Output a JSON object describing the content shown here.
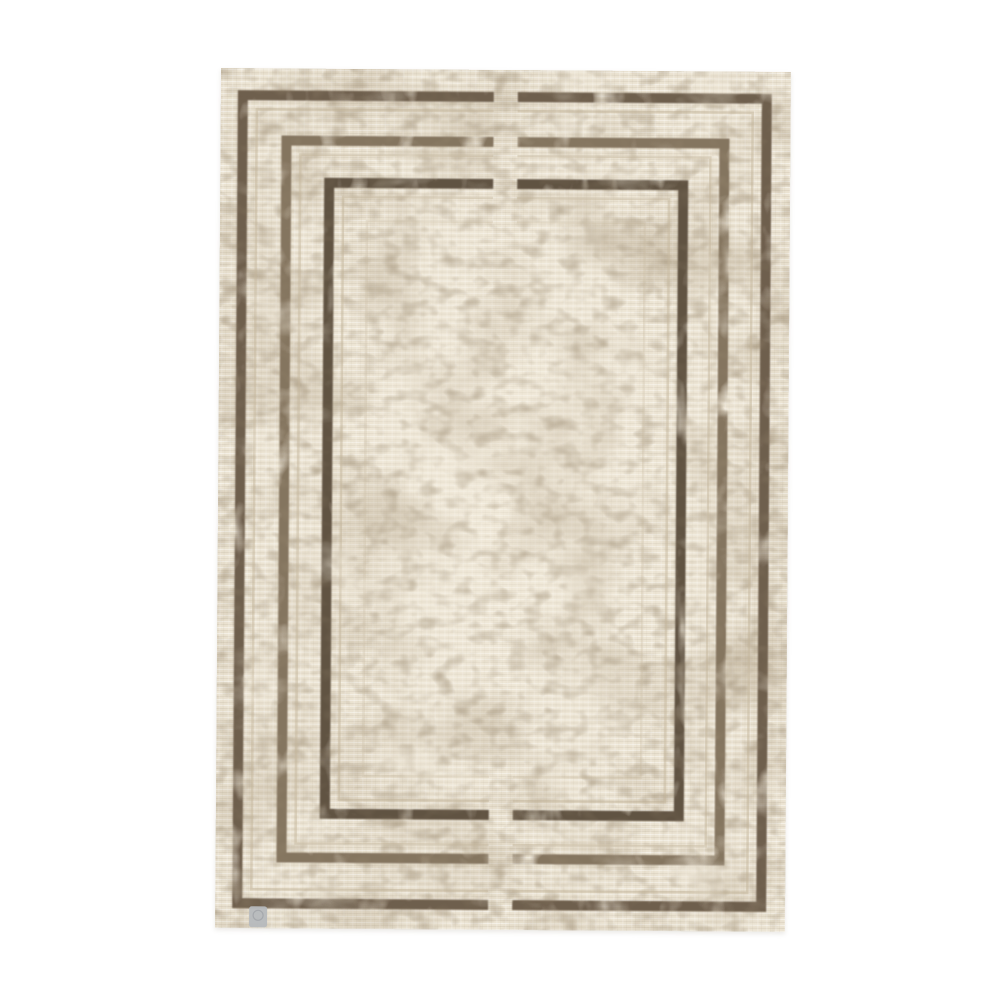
{
  "scene": {
    "description": "Product photograph of a rectangular vintage-style area rug lying flat on a plain white background. The rug has a distressed cream base with heavy taupe mottling and three nested dark-brown rectangular border frames. Each frame is interrupted by a short vertical gap at the top-center and bottom-center midline. A small grey fabric brand tag sits at the bottom-left edge of the rug.",
    "orientation": "portrait",
    "background": "plain white studio background",
    "objects": [
      "distressed area rug",
      "small grey fabric brand tag"
    ],
    "pattern": {
      "type": "nested rectangular border frames",
      "frame_count": 3,
      "center_gap": "frames break with a vertical gap at top and bottom midline",
      "finish": "eroded, worn, vintage distressed line edges",
      "texture": "horizontal weft striations with mottled taupe wear patches"
    },
    "colors": {
      "page_background": "#ffffff",
      "rug_base": "#ebe3d2",
      "rug_base_light": "#f3ecdd",
      "texture_taupe": "#ac9c82",
      "texture_speckle": "#8f7f66",
      "wear_cream": "#f0e9da",
      "border_outer": "#6e5f4e",
      "border_middle": "#84755f",
      "border_inner": "#615243",
      "echo_line": "#c6b89e",
      "tag_grey": "#b6b9bd",
      "tag_ring": "#989ba0"
    },
    "tag": {
      "position": "bottom-left edge of rug",
      "shape": "small rounded square fabric label",
      "visible_text": ""
    }
  }
}
